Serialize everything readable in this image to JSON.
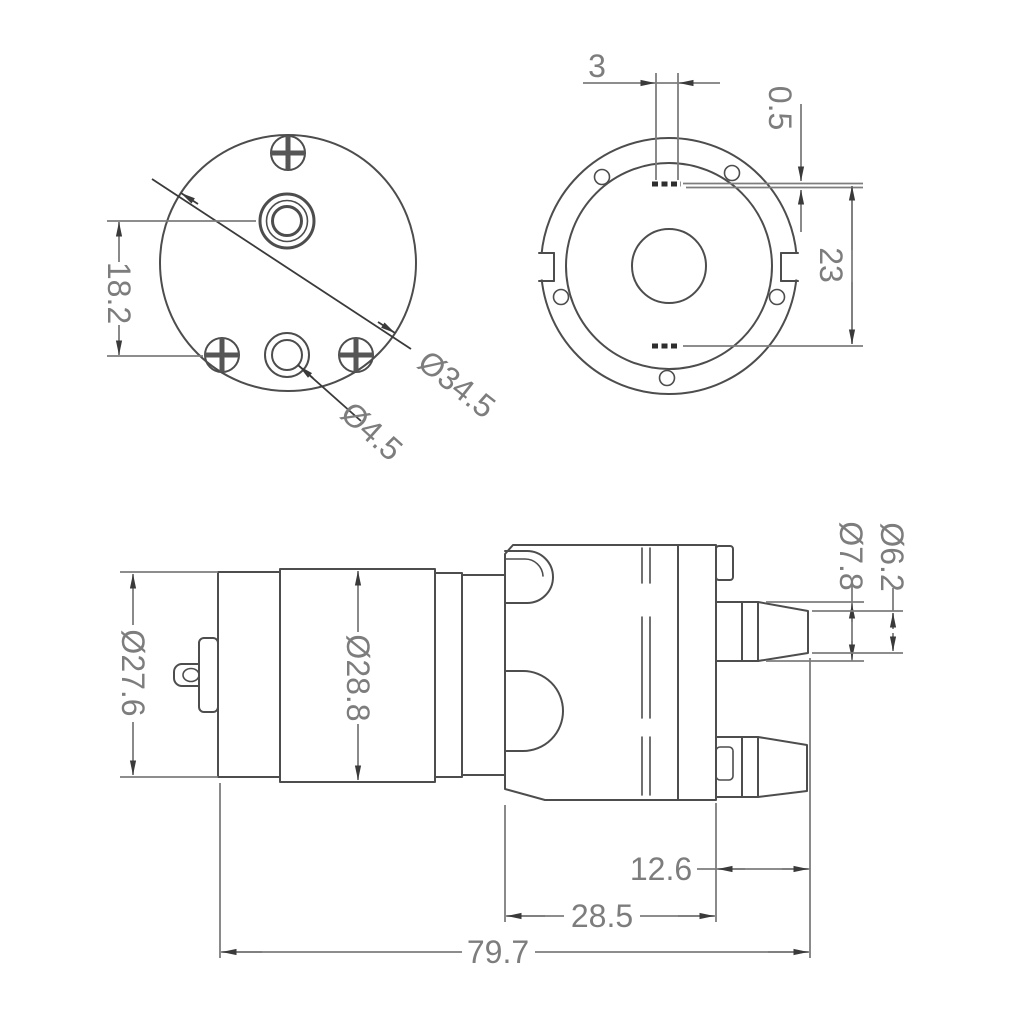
{
  "drawing": {
    "background": "#ffffff",
    "line_color": "#4d4d4d",
    "dim_line_color": "#7d7d7d",
    "text_color": "#7d7d7d",
    "views": {
      "front": {
        "name": "front-face-view",
        "dims": {
          "port_spacing": "18.2",
          "outer_diameter": "Ø34.5",
          "port_diameter": "Ø4.5"
        }
      },
      "rear": {
        "name": "rear-flange-view",
        "dims": {
          "slot_width": "3",
          "slot_offset": "0.5",
          "slot_spacing": "23"
        }
      },
      "side": {
        "name": "side-profile-view",
        "dims": {
          "motor_cap_diameter": "Ø27.6",
          "motor_body_diameter": "Ø28.8",
          "nozzle_tip_diameter": "Ø6.2",
          "nozzle_base_diameter": "Ø7.8",
          "nozzle_length": "12.6",
          "pump_head_length": "28.5",
          "overall_length": "79.7"
        }
      }
    }
  }
}
